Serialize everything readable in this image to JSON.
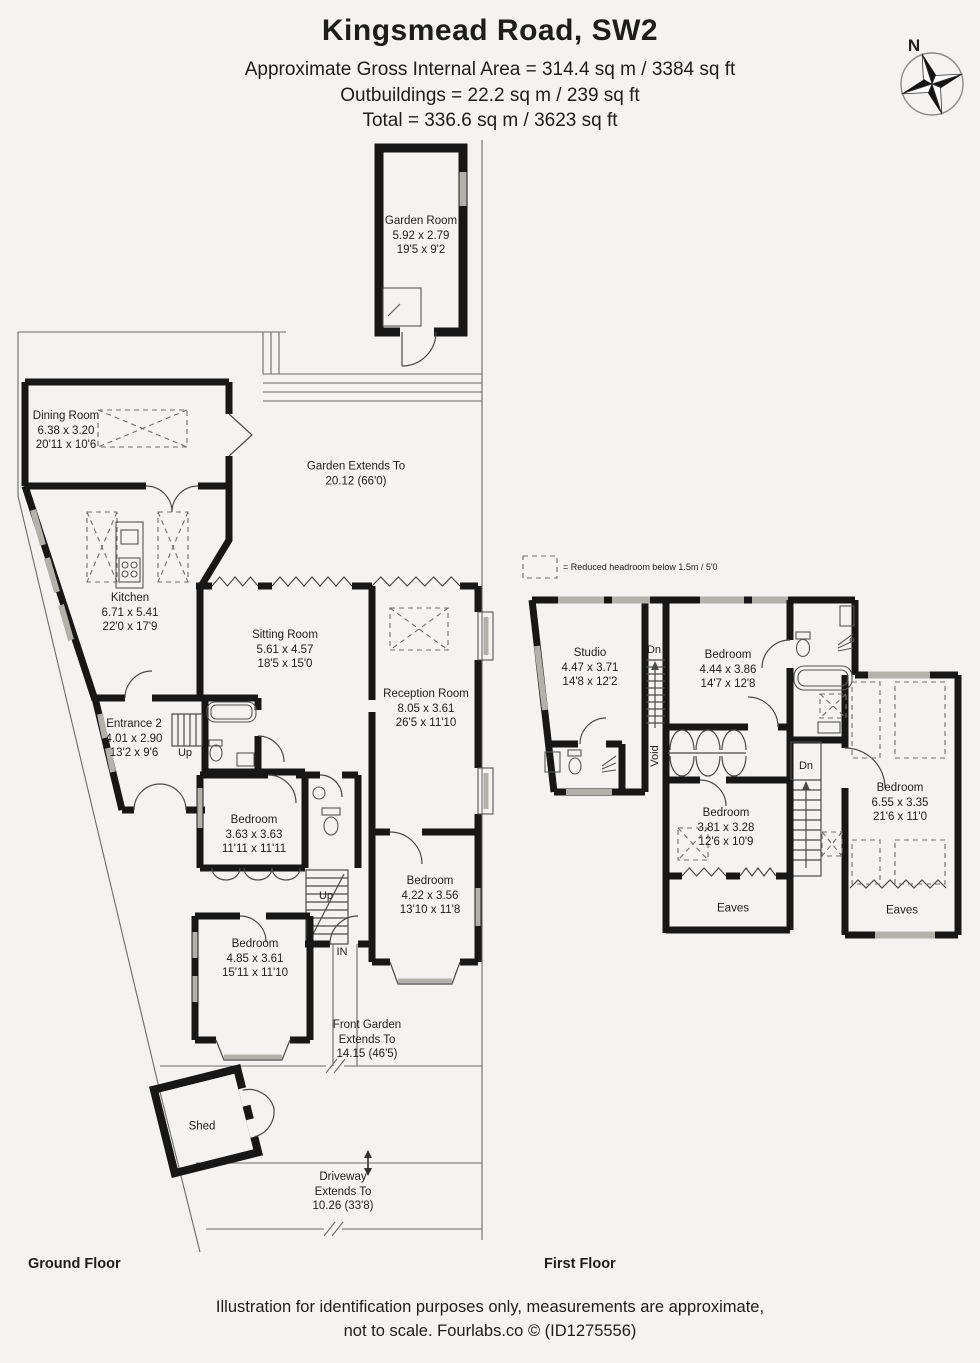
{
  "header": {
    "title": "Kingsmead Road, SW2",
    "area_line": "Approximate Gross Internal Area = 314.4 sq m / 3384 sq ft",
    "outbuildings_line": "Outbuildings = 22.2 sq m / 239 sq ft",
    "total_line": "Total = 336.6 sq m / 3623 sq ft",
    "compass_label": "N"
  },
  "legend": {
    "reduced_headroom": "= Reduced headroom below 1.5m / 5'0"
  },
  "ground_floor": {
    "title": "Ground Floor",
    "rooms": {
      "garden_room": {
        "name": "Garden Room",
        "metric": "5.92 x 2.79",
        "imperial": "19'5 x 9'2"
      },
      "dining_room": {
        "name": "Dining Room",
        "metric": "6.38 x 3.20",
        "imperial": "20'11 x 10'6"
      },
      "kitchen": {
        "name": "Kitchen",
        "metric": "6.71 x 5.41",
        "imperial": "22'0 x 17'9"
      },
      "sitting_room": {
        "name": "Sitting Room",
        "metric": "5.61 x 4.57",
        "imperial": "18'5 x 15'0"
      },
      "reception_room": {
        "name": "Reception Room",
        "metric": "8.05 x 3.61",
        "imperial": "26'5 x 11'10"
      },
      "entrance_2": {
        "name": "Entrance 2",
        "metric": "4.01 x 2.90",
        "imperial": "13'2 x 9'6"
      },
      "bedroom_1": {
        "name": "Bedroom",
        "metric": "3.63 x 3.63",
        "imperial": "11'11 x 11'11"
      },
      "bedroom_2": {
        "name": "Bedroom",
        "metric": "4.22 x 3.56",
        "imperial": "13'10 x 11'8"
      },
      "bedroom_3": {
        "name": "Bedroom",
        "metric": "4.85 x 3.61",
        "imperial": "15'11 x 11'10"
      },
      "shed": {
        "name": "Shed"
      }
    },
    "annotations": {
      "garden": {
        "line1": "Garden Extends To",
        "line2": "20.12 (66'0)"
      },
      "front_garden": {
        "line1": "Front Garden",
        "line2": "Extends To",
        "line3": "14.15 (46'5)"
      },
      "driveway": {
        "line1": "Driveway",
        "line2": "Extends To",
        "line3": "10.26 (33'8)"
      },
      "up_entrance": "Up",
      "up_main": "Up",
      "in_door": "IN"
    }
  },
  "first_floor": {
    "title": "First Floor",
    "rooms": {
      "studio": {
        "name": "Studio",
        "metric": "4.47 x 3.71",
        "imperial": "14'8 x 12'2"
      },
      "bedroom_1": {
        "name": "Bedroom",
        "metric": "4.44 x 3.86",
        "imperial": "14'7 x 12'8"
      },
      "bedroom_2": {
        "name": "Bedroom",
        "metric": "3.81 x 3.28",
        "imperial": "12'6 x 10'9"
      },
      "bedroom_3": {
        "name": "Bedroom",
        "metric": "6.55 x 3.35",
        "imperial": "21'6 x 11'0"
      }
    },
    "annotations": {
      "dn_top": "Dn",
      "dn_mid": "Dn",
      "void": "Void",
      "eaves_left": "Eaves",
      "eaves_right": "Eaves"
    }
  },
  "footer": {
    "line1": "Illustration for identification purposes only, measurements are approximate,",
    "line2": "not to scale. Fourlabs.co © (ID1275556)"
  }
}
